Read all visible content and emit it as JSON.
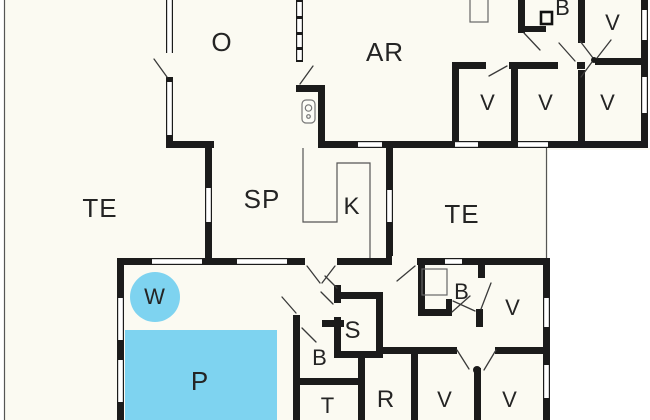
{
  "title": "Holiday house floor plan",
  "colors": {
    "wall": "#1b1b1b",
    "floor": "#fbfaf2",
    "outside": "#ffffff",
    "water": "#7ed3f0",
    "label": "#242424"
  },
  "rooms": {
    "o": {
      "label": "O"
    },
    "ar": {
      "label": "AR"
    },
    "b_top": {
      "label": "B"
    },
    "v_topright": {
      "label": "V"
    },
    "v_row1": {
      "label": "V"
    },
    "v_row2": {
      "label": "V"
    },
    "v_row3": {
      "label": "V"
    },
    "te_left": {
      "label": "TE"
    },
    "sp": {
      "label": "SP"
    },
    "k": {
      "label": "K"
    },
    "te_right": {
      "label": "TE"
    },
    "w": {
      "label": "W"
    },
    "p": {
      "label": "P"
    },
    "b_mid": {
      "label": "B"
    },
    "v_mid": {
      "label": "V"
    },
    "s": {
      "label": "S"
    },
    "b_low": {
      "label": "B"
    },
    "t": {
      "label": "T"
    },
    "r": {
      "label": "R"
    },
    "v_bot1": {
      "label": "V"
    },
    "v_bot2": {
      "label": "V"
    }
  }
}
